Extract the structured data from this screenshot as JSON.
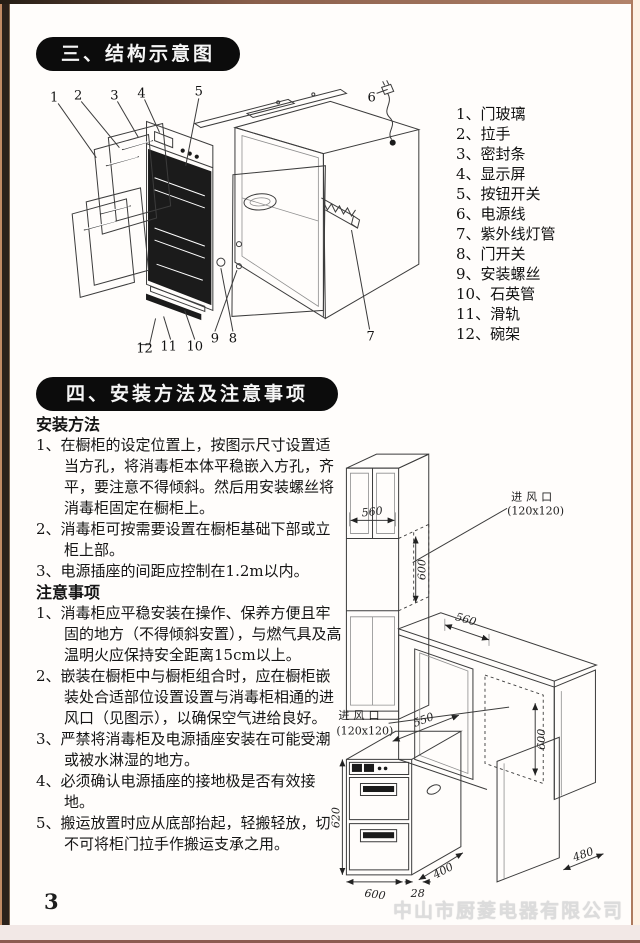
{
  "page": {
    "number": "3",
    "watermark": "中山市厨菱电器有限公司"
  },
  "section3": {
    "title": "三、结构示意图",
    "parts": [
      "1、门玻璃",
      "2、拉手",
      "3、密封条",
      "4、显示屏",
      "5、按钮开关",
      "6、电源线",
      "7、紫外线灯管",
      "8、门开关",
      "9、安装螺丝",
      "10、石英管",
      "11、滑轨",
      "12、碗架"
    ],
    "callouts": [
      "1",
      "2",
      "3",
      "4",
      "5",
      "6",
      "7",
      "8",
      "9",
      "10",
      "11",
      "12"
    ]
  },
  "section4": {
    "title": "四、安装方法及注意事项",
    "install_heading": "安装方法",
    "install_items": [
      {
        "no": "1、",
        "text": "在橱柜的设定位置上，按图示尺寸设置适当方孔，将消毒柜本体平稳嵌入方孔，齐平，要注意不得倾斜。然后用安装螺丝将消毒柜固定在橱柜上。"
      },
      {
        "no": "2、",
        "text": "消毒柜可按需要设置在橱柜基础下部或立柜上部。"
      },
      {
        "no": "3、",
        "text": "电源插座的间距应控制在1.2m以内。"
      }
    ],
    "notes_heading": "注意事项",
    "notes_items": [
      {
        "no": "1、",
        "text": "消毒柜应平稳安装在操作、保养方便且牢固的地方（不得倾斜安置），与燃气具及高温明火应保持安全距离15cm以上。"
      },
      {
        "no": "2、",
        "text": "嵌装在橱柜中与橱柜组合时，应在橱柜嵌装处合适部位设置设置与消毒柜相通的进风口（见图示），以确保空气进给良好。"
      },
      {
        "no": "3、",
        "text": "严禁将消毒柜及电源插座安装在可能受潮或被水淋湿的地方。"
      },
      {
        "no": "4、",
        "text": "必须确认电源插座的接地极是否有效接地。"
      },
      {
        "no": "5、",
        "text": "搬运放置时应从底部抬起，轻搬轻放，切不可将柜门拉手作搬运支承之用。"
      }
    ]
  },
  "diagram": {
    "inlet_label": "进风口",
    "inlet_size": "(120x120)",
    "dim_560_top": "560",
    "dim_600_top": "600",
    "dim_560_right": "560",
    "dim_600_right": "600",
    "dim_550": "550",
    "dim_620": "620",
    "dim_600_bottom": "600",
    "dim_400": "400",
    "dim_28": "28",
    "dim_480": "480"
  }
}
